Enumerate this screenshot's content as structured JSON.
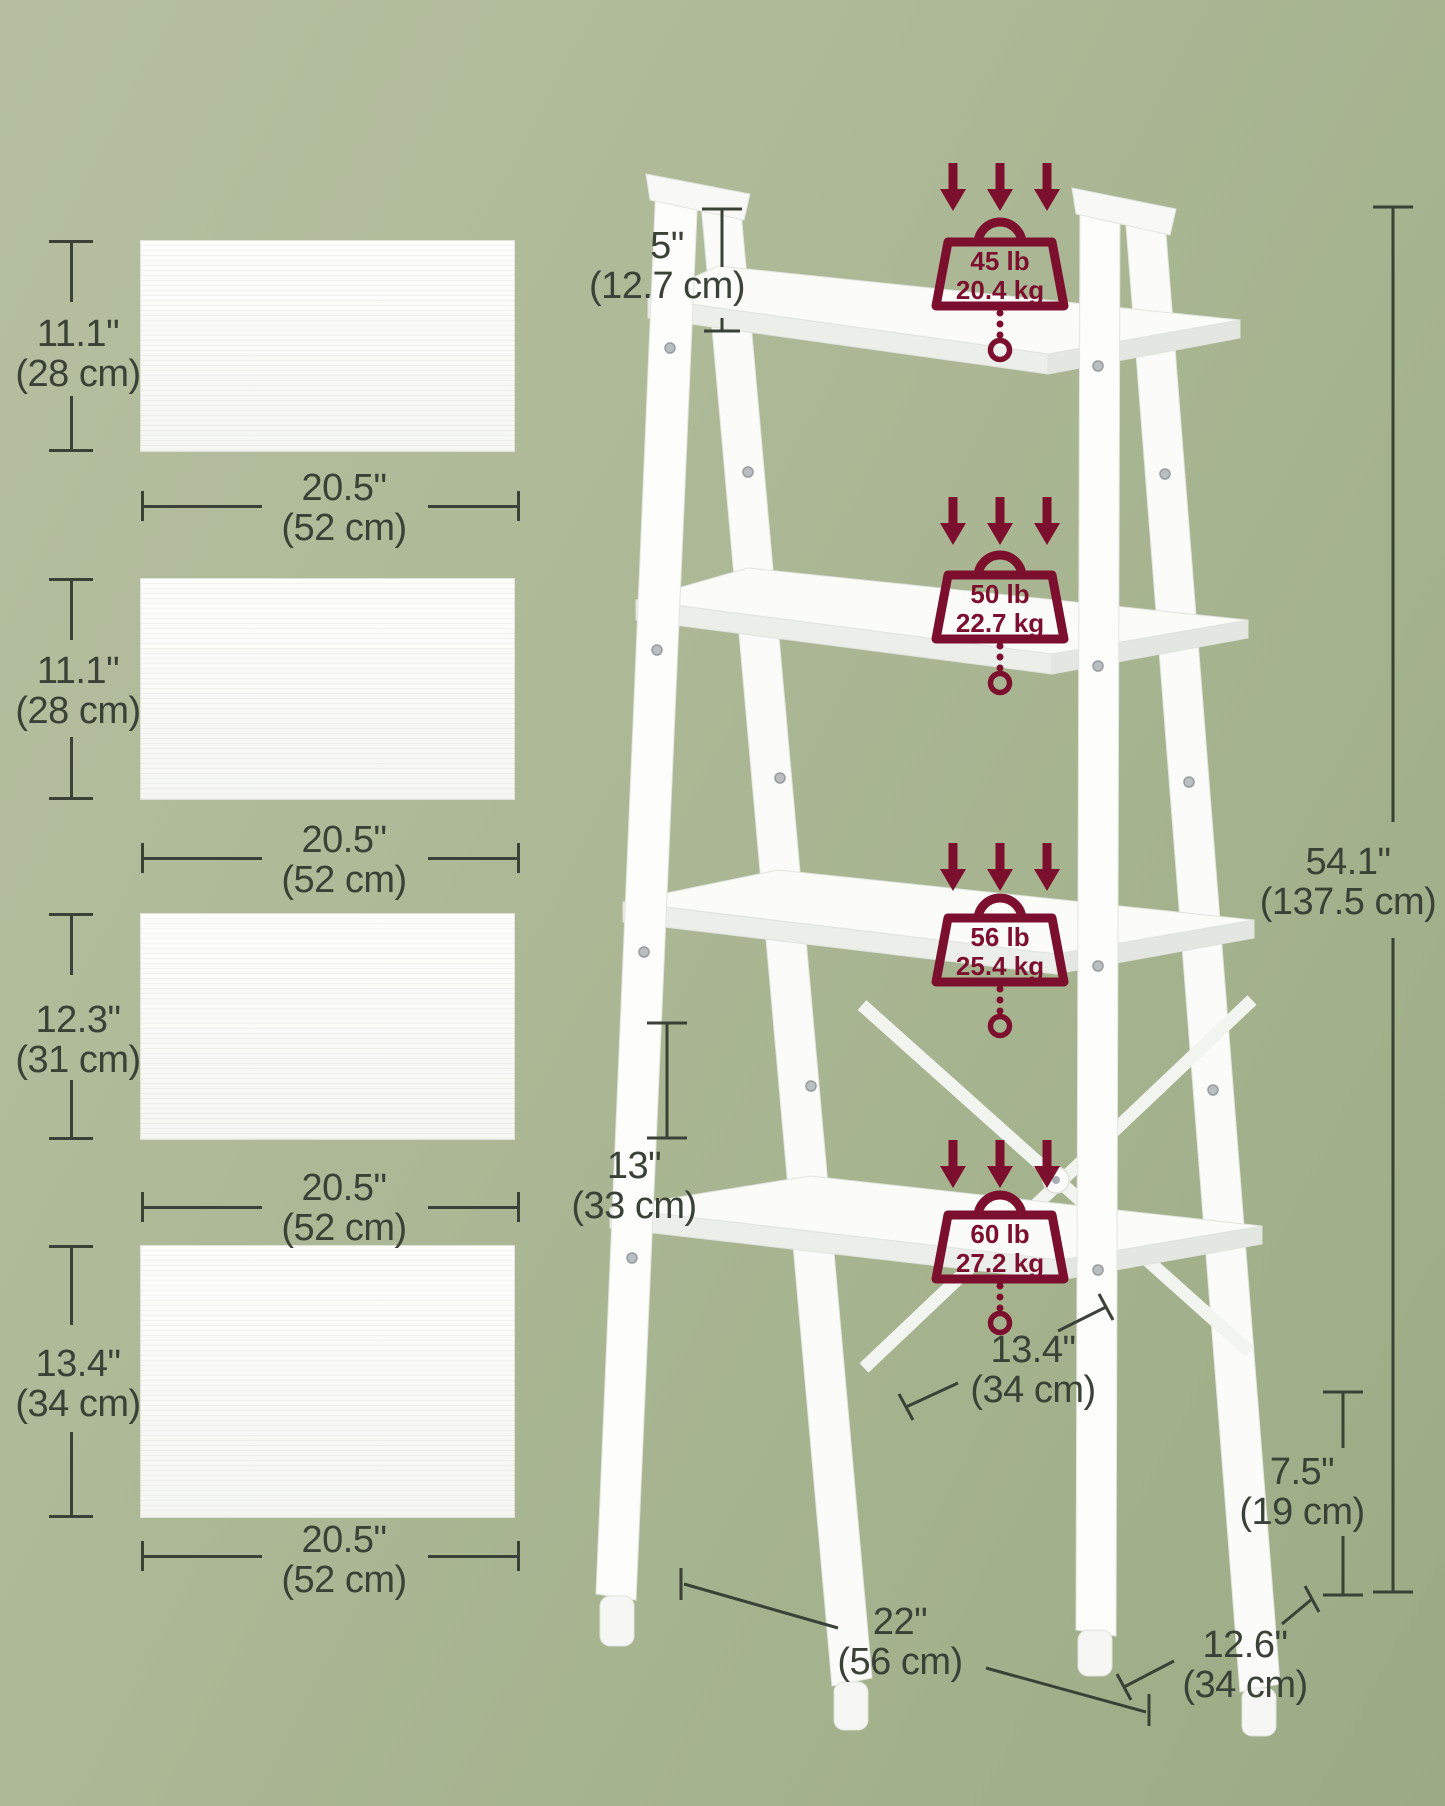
{
  "colors": {
    "background": "#aab794",
    "dimension_ink": "#3a4136",
    "capacity_red": "#7d0f2e",
    "board_white": "#fbfbf8"
  },
  "icons": {
    "load_direction": "down-arrow-icon",
    "load_capacity": "weight-badge-icon"
  },
  "left_panels": [
    {
      "height_imperial": "11.1\"",
      "height_metric": "(28 cm)",
      "width_imperial": "20.5\"",
      "width_metric": "(52 cm)"
    },
    {
      "height_imperial": "11.1\"",
      "height_metric": "(28 cm)",
      "width_imperial": "20.5\"",
      "width_metric": "(52 cm)"
    },
    {
      "height_imperial": "12.3\"",
      "height_metric": "(31 cm)",
      "width_imperial": "20.5\"",
      "width_metric": "(52 cm)"
    },
    {
      "height_imperial": "13.4\"",
      "height_metric": "(34 cm)",
      "width_imperial": "20.5\"",
      "width_metric": "(52 cm)"
    }
  ],
  "dimensions": {
    "top_clearance": {
      "imperial": "5\"",
      "metric": "(12.7 cm)"
    },
    "total_height": {
      "imperial": "54.1\"",
      "metric": "(137.5 cm)"
    },
    "shelf_spacing": {
      "imperial": "13\"",
      "metric": "(33 cm)"
    },
    "bottom_shelf_depth": {
      "imperial": "13.4\"",
      "metric": "(34 cm)"
    },
    "ground_clearance": {
      "imperial": "7.5\"",
      "metric": "(19 cm)"
    },
    "overall_width": {
      "imperial": "22\"",
      "metric": "(56 cm)"
    },
    "overall_depth": {
      "imperial": "12.6\"",
      "metric": "(34 cm)"
    }
  },
  "load_capacities": [
    {
      "pounds": "45 lb",
      "kilograms": "20.4 kg"
    },
    {
      "pounds": "50 lb",
      "kilograms": "22.7 kg"
    },
    {
      "pounds": "56 lb",
      "kilograms": "25.4 kg"
    },
    {
      "pounds": "60 lb",
      "kilograms": "27.2 kg"
    }
  ]
}
